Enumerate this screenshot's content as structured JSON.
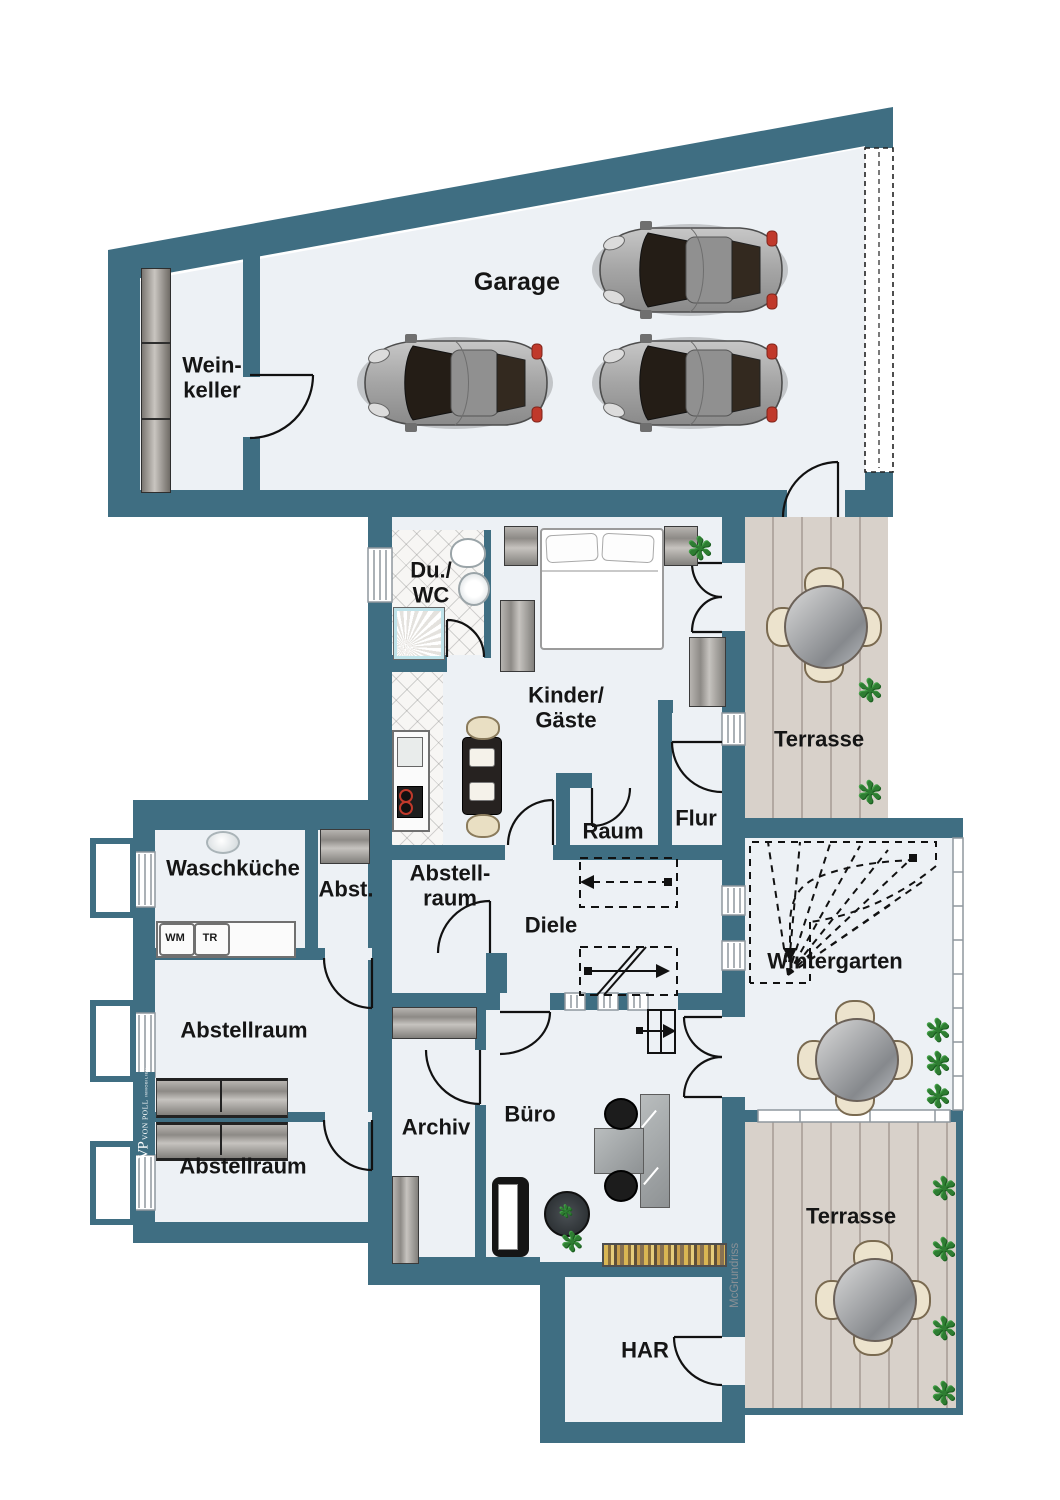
{
  "meta": {
    "plan_type": "floor plan",
    "width_px": 1060,
    "height_px": 1500
  },
  "rooms": {
    "garage": {
      "label": "Garage"
    },
    "weinkeller": {
      "line1": "Wein-",
      "line2": "keller"
    },
    "duwc": {
      "line1": "Du./",
      "line2": "WC"
    },
    "kinder_gaeste": {
      "line1": "Kinder/",
      "line2": "Gäste"
    },
    "terrasse_oben": {
      "label": "Terrasse"
    },
    "raum": {
      "label": "Raum"
    },
    "flur": {
      "label": "Flur"
    },
    "waschkueche": {
      "label": "Waschküche"
    },
    "abst": {
      "label": "Abst."
    },
    "abstellraum_mitte": {
      "line1": "Abstell-",
      "line2": "raum"
    },
    "diele": {
      "label": "Diele"
    },
    "wintergarten": {
      "label": "Wintergarten"
    },
    "abstellraum_links": {
      "label": "Abstellraum"
    },
    "abstellraum_unten": {
      "label": "Abstellraum"
    },
    "archiv": {
      "label": "Archiv"
    },
    "buero": {
      "label": "Büro"
    },
    "terrasse_unten": {
      "label": "Terrasse"
    },
    "har": {
      "label": "HAR"
    }
  },
  "appliances": {
    "washer": "WM",
    "dryer": "TR"
  },
  "branding": {
    "logo_monogram": "VP",
    "logo_name": "VON POLL",
    "logo_sub": "IMMOBILIEN",
    "watermark": "McGrundriss"
  },
  "icons": {
    "plant": "✻"
  },
  "colors": {
    "wall": "#3f6e82",
    "floor": "#edf1f5",
    "deck": "#d8d1ca",
    "deck_line": "#b2a8a1",
    "door_line": "#111111",
    "label_text": "#151515",
    "plant_green": "#2e7d32",
    "taillight_red": "#c0392b",
    "watermark_gray": "#8a9096",
    "logo_bg": "#3f6e82"
  }
}
